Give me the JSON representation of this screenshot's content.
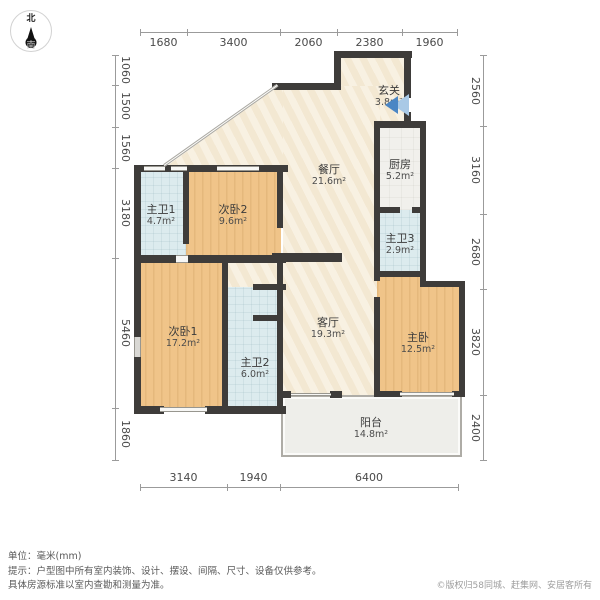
{
  "compass": {
    "north": "北",
    "south": "南"
  },
  "rooms": [
    {
      "id": "hallway",
      "name": "玄关",
      "area": "3.8m²",
      "x": 389,
      "y": 84
    },
    {
      "id": "dining",
      "name": "餐厅",
      "area": "21.6m²",
      "x": 329,
      "y": 163
    },
    {
      "id": "kitchen",
      "name": "厨房",
      "area": "5.2m²",
      "x": 400,
      "y": 158
    },
    {
      "id": "bath1",
      "name": "主卫1",
      "area": "4.7m²",
      "x": 161,
      "y": 203
    },
    {
      "id": "bed2",
      "name": "次卧2",
      "area": "9.6m²",
      "x": 233,
      "y": 203
    },
    {
      "id": "bath3",
      "name": "主卫3",
      "area": "2.9m²",
      "x": 400,
      "y": 232
    },
    {
      "id": "bed1",
      "name": "次卧1",
      "area": "17.2m²",
      "x": 183,
      "y": 325
    },
    {
      "id": "bath2",
      "name": "主卫2",
      "area": "6.0m²",
      "x": 255,
      "y": 356
    },
    {
      "id": "living",
      "name": "客厅",
      "area": "19.3m²",
      "x": 328,
      "y": 316
    },
    {
      "id": "master",
      "name": "主卧",
      "area": "12.5m²",
      "x": 418,
      "y": 331
    },
    {
      "id": "balcony",
      "name": "阳台",
      "area": "14.8m²",
      "x": 371,
      "y": 416
    }
  ],
  "dimensions": {
    "top": [
      {
        "label": "1680",
        "from": 140,
        "to": 187
      },
      {
        "label": "3400",
        "from": 187,
        "to": 280
      },
      {
        "label": "2060",
        "from": 280,
        "to": 337
      },
      {
        "label": "2380",
        "from": 337,
        "to": 402
      },
      {
        "label": "1960",
        "from": 402,
        "to": 457
      }
    ],
    "bottom": [
      {
        "label": "3140",
        "from": 140,
        "to": 227
      },
      {
        "label": "1940",
        "from": 227,
        "to": 280
      },
      {
        "label": "6400",
        "from": 280,
        "to": 458
      }
    ],
    "left": [
      {
        "label": "1060",
        "from": 55,
        "to": 85
      },
      {
        "label": "1500",
        "from": 85,
        "to": 127
      },
      {
        "label": "1560",
        "from": 127,
        "to": 168
      },
      {
        "label": "3180",
        "from": 168,
        "to": 258
      },
      {
        "label": "5460",
        "from": 258,
        "to": 408
      },
      {
        "label": "1860",
        "from": 408,
        "to": 460
      }
    ],
    "right": [
      {
        "label": "2560",
        "from": 55,
        "to": 126
      },
      {
        "label": "3160",
        "from": 126,
        "to": 214
      },
      {
        "label": "2680",
        "from": 214,
        "to": 289
      },
      {
        "label": "3820",
        "from": 289,
        "to": 395
      },
      {
        "label": "2400",
        "from": 395,
        "to": 460
      }
    ]
  },
  "footer": {
    "unit": "单位：毫米(mm)",
    "tip_line1": "提示：户型图中所有室内装饰、设计、摆设、间隔、尺寸、设备仅供参考。",
    "tip_line2": "具体房源标准以室内查勘和测量为准。",
    "copyright": "©版权归58同城、赶集网、安居客所有"
  },
  "colors": {
    "wood": "#f0c489",
    "beige": "#f6ecd8",
    "bath": "#dcebee",
    "service": "#f1f0ec",
    "balcony": "#eeeeea",
    "wall": "#3e3c3a",
    "door_accent": "#4b86c4"
  }
}
